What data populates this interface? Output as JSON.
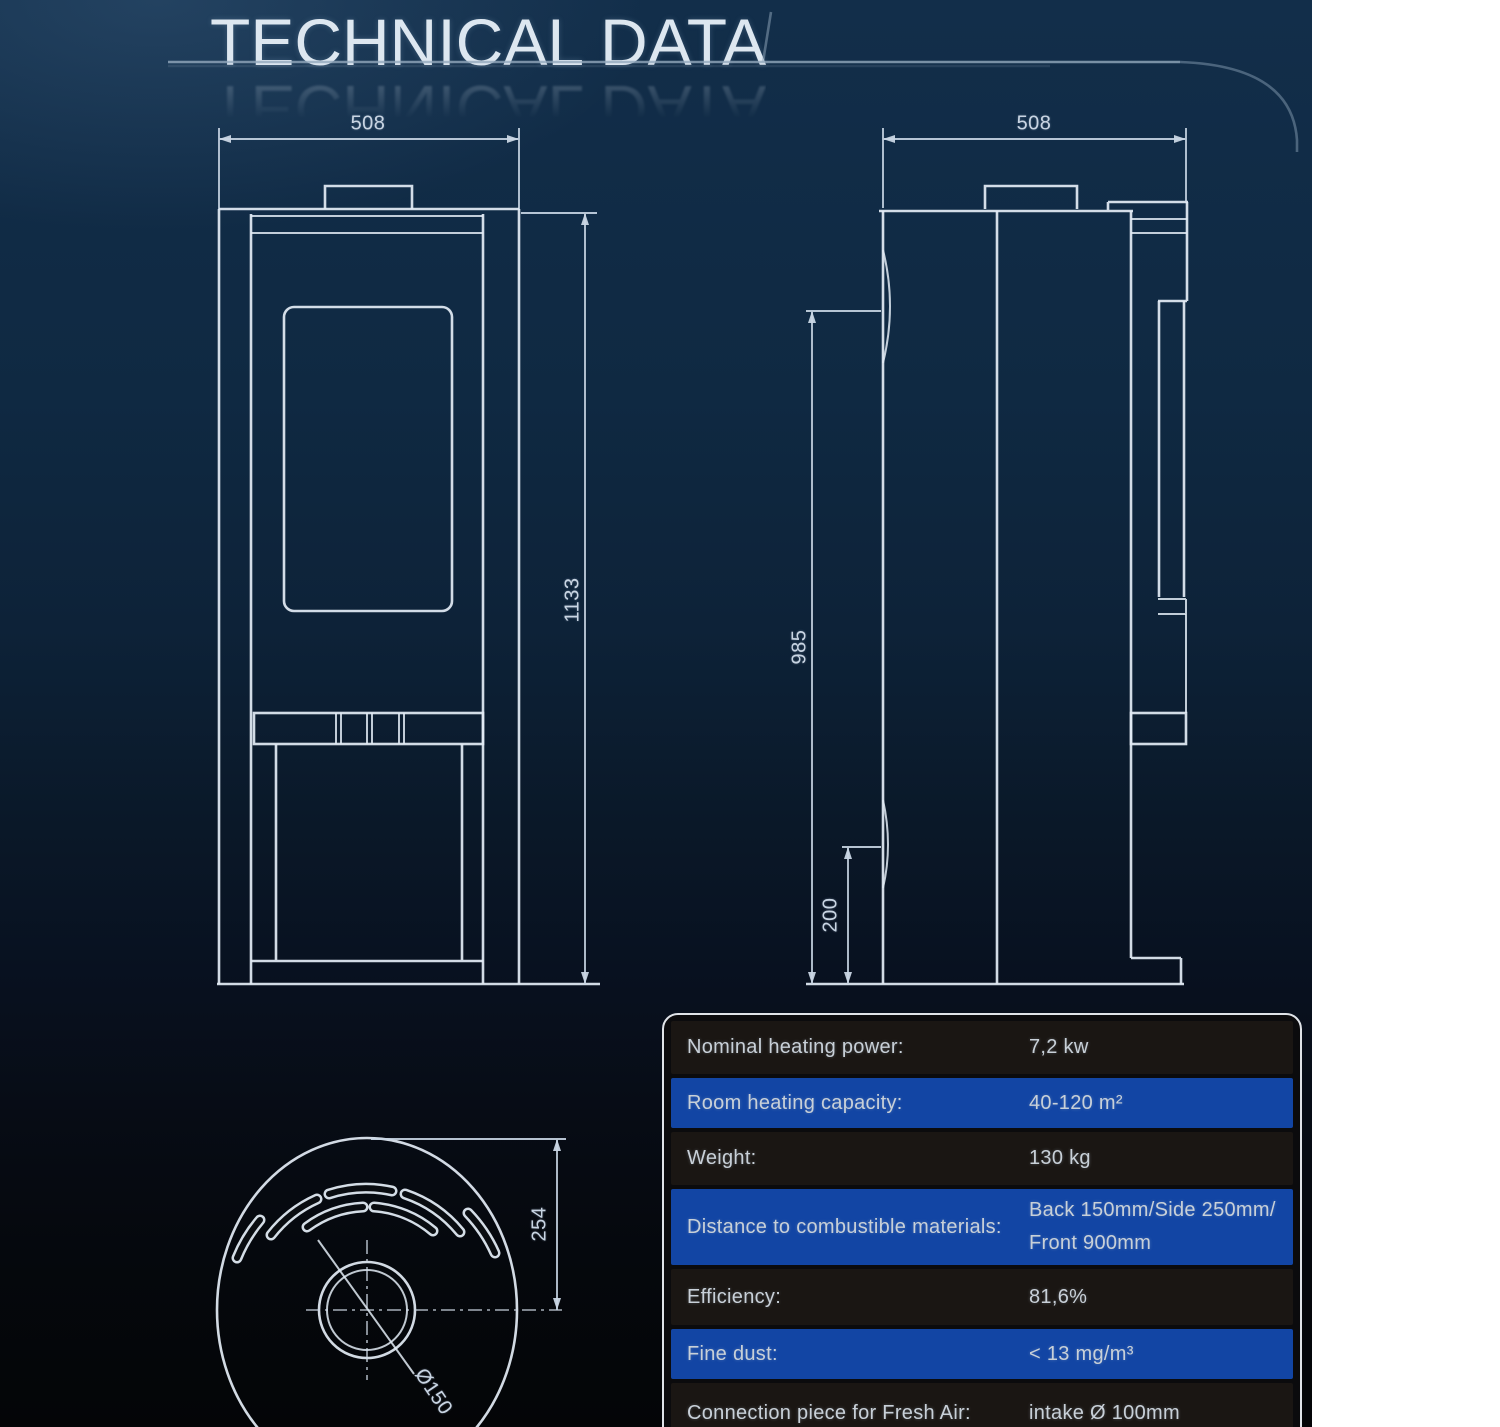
{
  "page": {
    "title": "TECHNICAL DATA"
  },
  "front_view": {
    "width_dim": "508",
    "height_dim": "1133"
  },
  "side_view": {
    "depth_dim": "508",
    "body_height_dim": "985",
    "clearance_dim": "200"
  },
  "top_view": {
    "offset_dim": "254",
    "flue_diameter_dim": "Ø150"
  },
  "spec_table": {
    "rows": [
      {
        "label": "Nominal heating power:",
        "value": "7,2 kw"
      },
      {
        "label": "Room heating capacity:",
        "value": "40-120 m²"
      },
      {
        "label": "Weight:",
        "value": "130 kg"
      },
      {
        "label": "Distance to combustible materials:",
        "value": "Back 150mm/Side 250mm/",
        "value2": "Front 900mm"
      },
      {
        "label": "Efficiency:",
        "value": "81,6%"
      },
      {
        "label": "Fine dust:",
        "value": "< 13 mg/m³"
      },
      {
        "label": "Connection piece for Fresh Air:",
        "value": "intake Ø 100mm"
      }
    ]
  }
}
